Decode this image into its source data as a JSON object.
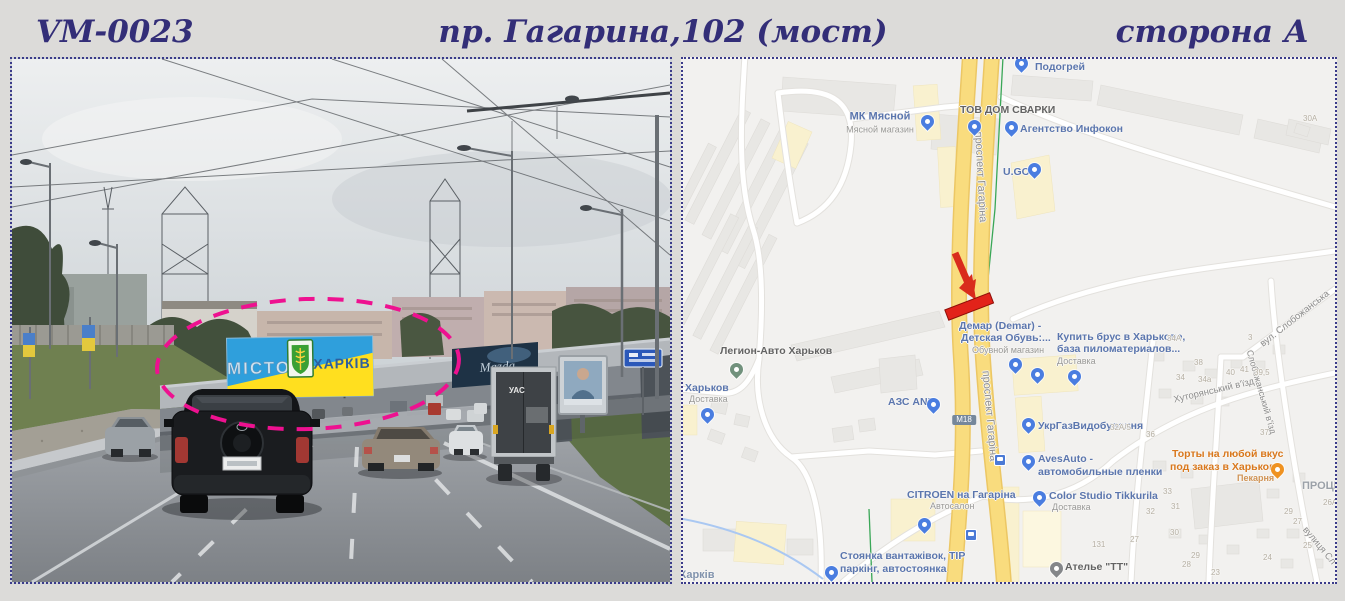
{
  "header": {
    "code": "VM-0023",
    "address": "пр. Гагарина,102 (мост)",
    "side": "сторона А"
  },
  "photo": {
    "billboard": {
      "left_text": "МІСТО",
      "right_text": "ХАРКІВ",
      "blue_color": "#2f9fdc",
      "yellow_color": "#ffdf1f"
    },
    "mazda_text": "Mazda",
    "truck_text": "УАС",
    "highlight_color": "#ee1190"
  },
  "map": {
    "marker": {
      "name": "billboard-location",
      "color": "#e2231a"
    },
    "road_fill": "#f9dc7e",
    "labels": [
      {
        "t": "МК Мясной",
        "x": 197,
        "y": 58,
        "s": 11,
        "c": "poi",
        "a": "m"
      },
      {
        "t": "Мясной магазин",
        "x": 197,
        "y": 71,
        "s": 9,
        "c": "sub",
        "a": "m"
      },
      {
        "t": "ТОВ ДОМ СВАРКИ",
        "x": 277,
        "y": 46,
        "s": 10.5,
        "c": "dark"
      },
      {
        "t": "Подогрей",
        "x": 352,
        "y": 3,
        "s": 10.5,
        "c": "poi"
      },
      {
        "t": "Агентство Инфокон",
        "x": 337,
        "y": 65,
        "s": 10.5,
        "c": "poi"
      },
      {
        "t": "U.GO",
        "x": 320,
        "y": 108,
        "s": 10.5,
        "c": "poi"
      },
      {
        "t": "проспект Гагаріна",
        "x": 297,
        "y": 118,
        "s": 11,
        "c": "street",
        "a": "m",
        "r": 87
      },
      {
        "t": "проспект Гагаріна",
        "x": 306,
        "y": 357,
        "s": 11,
        "c": "street",
        "a": "m",
        "r": 85
      },
      {
        "t": "Демар (Demar) -",
        "x": 276,
        "y": 262,
        "s": 10.5,
        "c": "poi"
      },
      {
        "t": "Детская Обувь:...",
        "x": 278,
        "y": 274,
        "s": 10.5,
        "c": "poi"
      },
      {
        "t": "Обувной магазин",
        "x": 289,
        "y": 287,
        "s": 9,
        "c": "sub"
      },
      {
        "t": "Купить брус в Харькове,",
        "x": 374,
        "y": 273,
        "s": 10.5,
        "c": "poi"
      },
      {
        "t": "база пиломатериалов...",
        "x": 374,
        "y": 285,
        "s": 10.5,
        "c": "poi"
      },
      {
        "t": "Доставка",
        "x": 374,
        "y": 298,
        "s": 9,
        "c": "sub"
      },
      {
        "t": "Легион-Авто Харьков",
        "x": 37,
        "y": 287,
        "s": 10.5,
        "c": "dark"
      },
      {
        "t": "Харьков",
        "x": 2,
        "y": 324,
        "s": 10.5,
        "c": "poi"
      },
      {
        "t": "Доставка",
        "x": 6,
        "y": 336,
        "s": 9,
        "c": "sub"
      },
      {
        "t": "АЗС ANP",
        "x": 205,
        "y": 338,
        "s": 10.5,
        "c": "poi"
      },
      {
        "t": "M18",
        "x": 281,
        "y": 361,
        "s": 8,
        "c": "shield",
        "a": "m"
      },
      {
        "t": "УкрГазВидобування",
        "x": 355,
        "y": 362,
        "s": 10.5,
        "c": "poi"
      },
      {
        "t": "AvesAuto -",
        "x": 355,
        "y": 395,
        "s": 10.5,
        "c": "poi"
      },
      {
        "t": "автомобильные пленки",
        "x": 355,
        "y": 408,
        "s": 10.5,
        "c": "poi"
      },
      {
        "t": "Color Studio Tikkurila",
        "x": 366,
        "y": 432,
        "s": 10.5,
        "c": "poi"
      },
      {
        "t": "Доставка",
        "x": 369,
        "y": 444,
        "s": 9,
        "c": "sub"
      },
      {
        "t": "CITROEN на Гагаріна",
        "x": 224,
        "y": 431,
        "s": 10.5,
        "c": "poi"
      },
      {
        "t": "Автосалон",
        "x": 247,
        "y": 443,
        "s": 9,
        "c": "sub"
      },
      {
        "t": "Торты на любой вкус",
        "x": 489,
        "y": 390,
        "s": 10.5,
        "c": "org"
      },
      {
        "t": "под заказ в Харькове",
        "x": 487,
        "y": 403,
        "s": 10.5,
        "c": "org"
      },
      {
        "t": "Пекарня",
        "x": 554,
        "y": 415,
        "s": 9,
        "c": "orgsub"
      },
      {
        "t": "ПРОЦЕ",
        "x": 619,
        "y": 422,
        "s": 11,
        "c": "area"
      },
      {
        "t": "Стоянка вантажівок, TIP",
        "x": 157,
        "y": 492,
        "s": 10.5,
        "c": "poi"
      },
      {
        "t": "паркінг, автостоянка",
        "x": 157,
        "y": 505,
        "s": 10.5,
        "c": "poi"
      },
      {
        "t": "Ателье \"ТТ\"",
        "x": 382,
        "y": 503,
        "s": 10.5,
        "c": "dark"
      },
      {
        "t": "Харків",
        "x": -4,
        "y": 511,
        "s": 11,
        "c": "city"
      },
      {
        "t": "Хуторянський в'їзд",
        "x": 531,
        "y": 332,
        "s": 9.5,
        "c": "street",
        "a": "m",
        "r": -13
      },
      {
        "t": "вул. Слобожанська",
        "x": 612,
        "y": 260,
        "s": 9.5,
        "c": "street",
        "a": "m",
        "r": -38
      },
      {
        "t": "Слобожанський в'їзд",
        "x": 578,
        "y": 333,
        "s": 9,
        "c": "street",
        "a": "m",
        "r": 74
      },
      {
        "t": "вулиця Сл",
        "x": 636,
        "y": 487,
        "s": 9.5,
        "c": "street",
        "a": "m",
        "r": 50
      },
      {
        "t": "30А",
        "x": 620,
        "y": 56,
        "s": 8,
        "c": "hn"
      },
      {
        "t": "34А",
        "x": 484,
        "y": 276,
        "s": 8,
        "c": "hn"
      },
      {
        "t": "3",
        "x": 565,
        "y": 275,
        "s": 8,
        "c": "hn"
      },
      {
        "t": "38",
        "x": 511,
        "y": 300,
        "s": 8,
        "c": "hn"
      },
      {
        "t": "40",
        "x": 543,
        "y": 310,
        "s": 8,
        "c": "hn"
      },
      {
        "t": "41",
        "x": 557,
        "y": 307,
        "s": 8,
        "c": "hn"
      },
      {
        "t": "39,5",
        "x": 571,
        "y": 310,
        "s": 8,
        "c": "hn"
      },
      {
        "t": "34",
        "x": 493,
        "y": 315,
        "s": 8,
        "c": "hn"
      },
      {
        "t": "34а",
        "x": 515,
        "y": 317,
        "s": 8,
        "c": "hn"
      },
      {
        "t": "32А/5",
        "x": 427,
        "y": 365,
        "s": 8,
        "c": "hn"
      },
      {
        "t": "36",
        "x": 463,
        "y": 372,
        "s": 8,
        "c": "hn"
      },
      {
        "t": "37",
        "x": 577,
        "y": 370,
        "s": 8,
        "c": "hn"
      },
      {
        "t": "33",
        "x": 480,
        "y": 429,
        "s": 8,
        "c": "hn"
      },
      {
        "t": "32",
        "x": 463,
        "y": 449,
        "s": 8,
        "c": "hn"
      },
      {
        "t": "31",
        "x": 488,
        "y": 444,
        "s": 8,
        "c": "hn"
      },
      {
        "t": "30",
        "x": 487,
        "y": 470,
        "s": 8,
        "c": "hn"
      },
      {
        "t": "29",
        "x": 508,
        "y": 493,
        "s": 8,
        "c": "hn"
      },
      {
        "t": "28",
        "x": 499,
        "y": 502,
        "s": 8,
        "c": "hn"
      },
      {
        "t": "27",
        "x": 447,
        "y": 477,
        "s": 8,
        "c": "hn"
      },
      {
        "t": "131",
        "x": 409,
        "y": 482,
        "s": 8,
        "c": "hn"
      },
      {
        "t": "29",
        "x": 601,
        "y": 449,
        "s": 8,
        "c": "hn"
      },
      {
        "t": "27",
        "x": 610,
        "y": 459,
        "s": 8,
        "c": "hn"
      },
      {
        "t": "26А",
        "x": 640,
        "y": 440,
        "s": 8,
        "c": "hn"
      },
      {
        "t": "25",
        "x": 620,
        "y": 483,
        "s": 8,
        "c": "hn"
      },
      {
        "t": "24",
        "x": 580,
        "y": 495,
        "s": 8,
        "c": "hn"
      },
      {
        "t": "23",
        "x": 528,
        "y": 510,
        "s": 8,
        "c": "hn"
      }
    ],
    "pins": [
      {
        "x": 244,
        "y": 72,
        "k": "blue",
        "n": "МК Мясной"
      },
      {
        "x": 291,
        "y": 77,
        "k": "blue",
        "n": "ТОВ ДОМ СВАРКИ"
      },
      {
        "x": 328,
        "y": 78,
        "k": "blue",
        "n": "Агентство Инфокон"
      },
      {
        "x": 338,
        "y": 14,
        "k": "blue",
        "n": "Подогрей"
      },
      {
        "x": 351,
        "y": 120,
        "k": "blue",
        "n": "U.GO"
      },
      {
        "x": 332,
        "y": 315,
        "k": "blue",
        "n": "Демар (Demar)"
      },
      {
        "x": 354,
        "y": 325,
        "k": "blue",
        "n": "магазин"
      },
      {
        "x": 391,
        "y": 327,
        "k": "blue",
        "n": "Купить брус в Харькове"
      },
      {
        "x": 24,
        "y": 365,
        "k": "blue",
        "n": "Харьков Доставка"
      },
      {
        "x": 250,
        "y": 355,
        "k": "blue",
        "n": "АЗС ANP"
      },
      {
        "x": 345,
        "y": 375,
        "k": "blue",
        "n": "УкрГазВидобування"
      },
      {
        "x": 345,
        "y": 412,
        "k": "blue",
        "n": "AvesAuto"
      },
      {
        "x": 356,
        "y": 448,
        "k": "blue",
        "n": "Color Studio Tikkurila"
      },
      {
        "x": 241,
        "y": 475,
        "k": "blue",
        "n": "CITROEN на Гагаріна"
      },
      {
        "x": 148,
        "y": 523,
        "k": "blue",
        "n": "Стоянка вантажівок"
      },
      {
        "x": 53,
        "y": 320,
        "k": "green",
        "n": "Легион-Авто Харьков"
      },
      {
        "x": 594,
        "y": 420,
        "k": "orange",
        "n": "Пекарня Торты"
      },
      {
        "x": 373,
        "y": 519,
        "k": "gray",
        "n": "Ателье ТТ"
      }
    ],
    "transit": [
      {
        "x": 316,
        "y": 400
      },
      {
        "x": 287,
        "y": 475
      }
    ]
  }
}
